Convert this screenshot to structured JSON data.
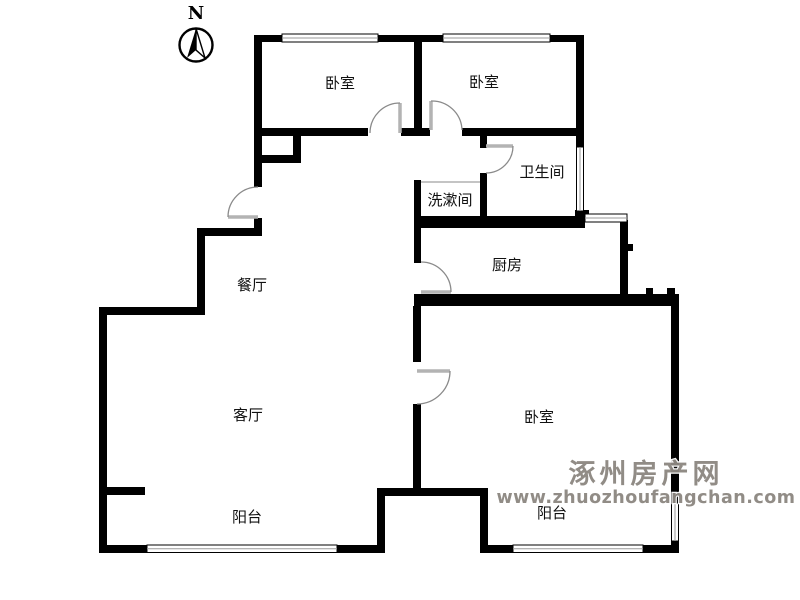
{
  "page": {
    "background": "#ffffff"
  },
  "compass": {
    "label": "N"
  },
  "floor_plan": {
    "rooms": [
      {
        "name": "bedroom-northwest",
        "label": "卧室"
      },
      {
        "name": "bedroom-northeast",
        "label": "卧室"
      },
      {
        "name": "bathroom",
        "label": "卫生间"
      },
      {
        "name": "washroom",
        "label": "洗漱间"
      },
      {
        "name": "kitchen",
        "label": "厨房"
      },
      {
        "name": "dining-room",
        "label": "餐厅"
      },
      {
        "name": "living-room",
        "label": "客厅"
      },
      {
        "name": "bedroom-south",
        "label": "卧室"
      },
      {
        "name": "balcony-southwest",
        "label": "阳台"
      },
      {
        "name": "balcony-southeast",
        "label": "阳台"
      }
    ]
  },
  "watermark": {
    "site_name": "涿州房产网",
    "site_url": "www.zhuozhoufangchan.com",
    "color": "#8d8882"
  },
  "colors": {
    "wall": "#000000",
    "door": "#8a8a8a",
    "window": "#9a9a9a"
  }
}
